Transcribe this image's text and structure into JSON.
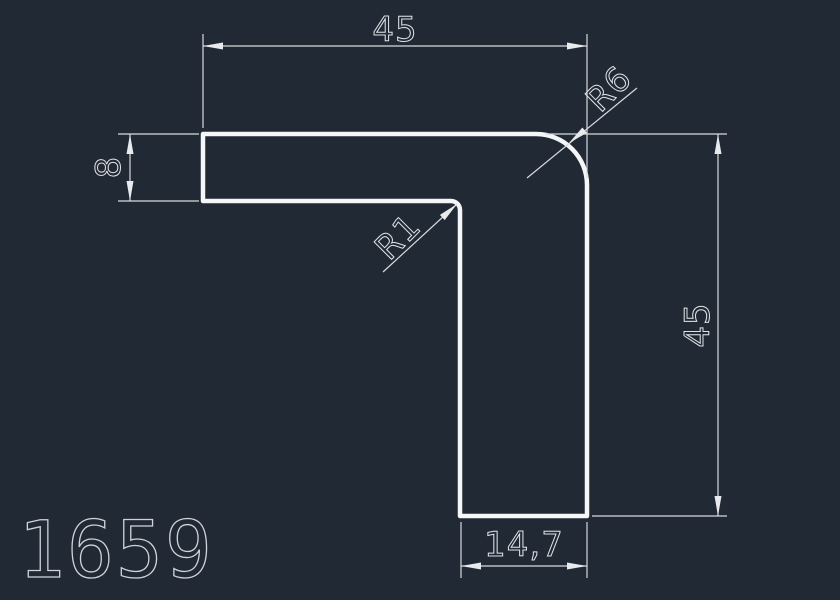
{
  "canvas": {
    "background_color": "#212934",
    "outline_color": "#f5f6f7",
    "dim_line_color": "#d6dade",
    "text_color": "#dfe3e6"
  },
  "drawing": {
    "part_number": "1659",
    "dims": {
      "top_width": "45",
      "right_height": "45",
      "left_thickness": "8",
      "bottom_width": "14,7",
      "outer_radius_label": "R6",
      "inner_radius_label": "R1"
    }
  }
}
